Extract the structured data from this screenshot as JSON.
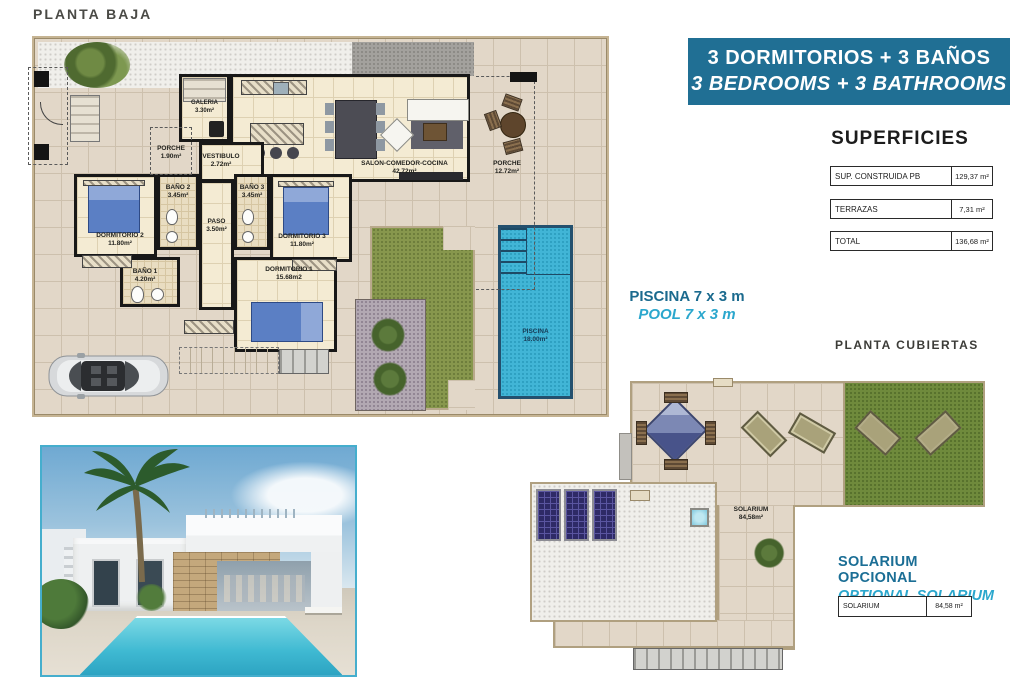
{
  "planta_baja": {
    "title": "PLANTA BAJA",
    "rooms": [
      {
        "name": "GALERIA",
        "area": "3.30m²"
      },
      {
        "name": "PORCHE",
        "area": "1.90m²"
      },
      {
        "name": "VESTIBULO",
        "area": "2.72m²"
      },
      {
        "name": "SALON-COMEDOR-COCINA",
        "area": "42.72m²"
      },
      {
        "name": "PORCHE",
        "area": "12.72m²"
      },
      {
        "name": "BAÑO 2",
        "area": "3.45m²"
      },
      {
        "name": "BAÑO 3",
        "area": "3.45m²"
      },
      {
        "name": "PASO",
        "area": "3.50m²"
      },
      {
        "name": "DORMITORIO 2",
        "area": "11.80m²"
      },
      {
        "name": "DORMITORIO 3",
        "area": "11.80m²"
      },
      {
        "name": "BAÑO 1",
        "area": "4.20m²"
      },
      {
        "name": "DORMITORIO 1",
        "area": "15.68m2"
      },
      {
        "name": "PISCINA",
        "area": "18.00m²"
      }
    ]
  },
  "banner": {
    "line1": "3 DORMITORIOS + 3 BAÑOS",
    "line2": "3 BEDROOMS + 3 BATHROOMS",
    "bg": "#206f94"
  },
  "superficies": {
    "title": "SUPERFICIES",
    "rows": [
      {
        "label": "SUP. CONSTRUIDA PB",
        "value": "129,37 m²"
      },
      {
        "label": "TERRAZAS",
        "value": "7,31 m²"
      },
      {
        "label": "TOTAL",
        "value": "136,68 m²"
      }
    ]
  },
  "pool_note": {
    "line1": "PISCINA 7 x 3 m",
    "line2": "POOL 7 x 3 m"
  },
  "planta_cubiertas": {
    "title": "PLANTA CUBIERTAS",
    "solarium": {
      "name": "SOLARIUM",
      "area": "84,58m²"
    }
  },
  "solarium_note": {
    "line1": "SOLARIUM OPCIONAL",
    "line2": "OPTIONAL SOLARIUM",
    "table": {
      "label": "SOLARIUM",
      "value": "84,58 m²"
    }
  },
  "colors": {
    "accent_dark_teal": "#1b6a8e",
    "accent_cyan": "#2ba7cd",
    "banner_bg": "#206f94",
    "pool_water": "#41b5d6",
    "lawn_green": "#87974d",
    "photo_frame": "#45aecd"
  }
}
